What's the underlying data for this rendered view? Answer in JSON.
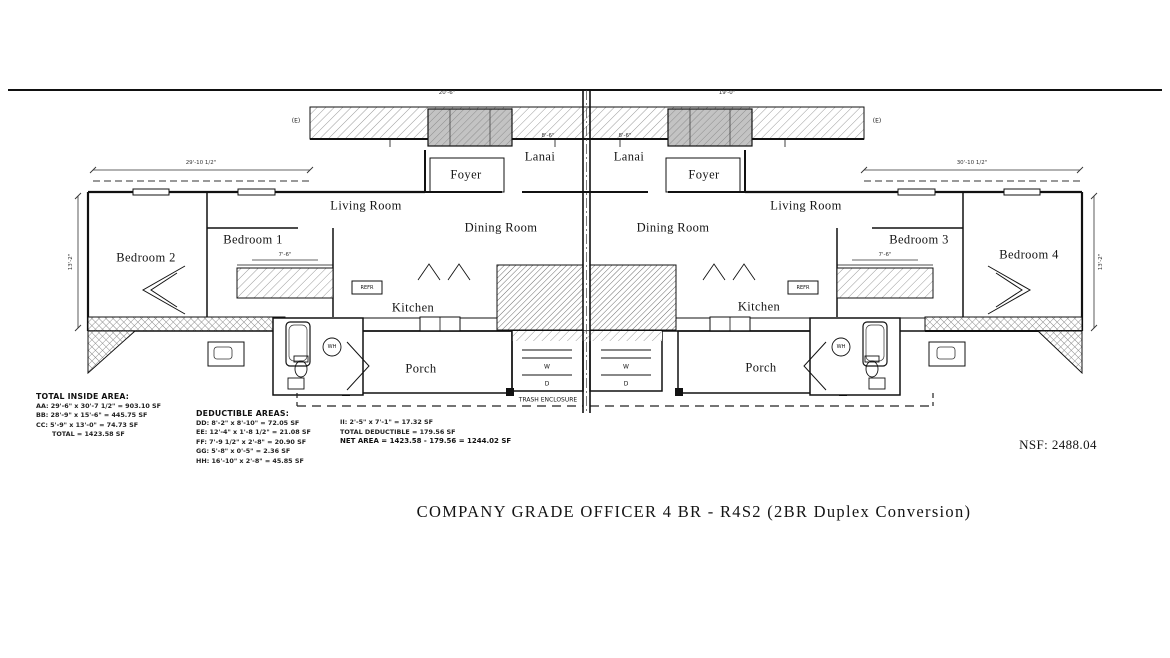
{
  "sheet": {
    "title": "COMPANY GRADE OFFICER 4 BR - R4S2 (2BR Duplex Conversion)",
    "nsf_label": "NSF: 2488.04"
  },
  "rooms": {
    "lanai_left": "Lanai",
    "lanai_right": "Lanai",
    "foyer_left": "Foyer",
    "foyer_right": "Foyer",
    "living_left": "Living Room",
    "living_right": "Living Room",
    "dining_left": "Dining Room",
    "dining_right": "Dining Room",
    "bedroom1": "Bedroom 1",
    "bedroom2": "Bedroom 2",
    "bedroom3": "Bedroom 3",
    "bedroom4": "Bedroom 4",
    "kitchen_left": "Kitchen",
    "kitchen_right": "Kitchen",
    "porch_left": "Porch",
    "porch_right": "Porch"
  },
  "fixtures": {
    "refr_left": "REFR",
    "refr_right": "REFR",
    "wh_left": "WH",
    "wh_right": "WH",
    "washer_left": "W",
    "dryer_left": "D",
    "washer_right": "W",
    "dryer_right": "D",
    "trash_enclosure": "TRASH ENCLOSURE",
    "existing_left": "(E)",
    "existing_right": "(E)"
  },
  "dimensions": {
    "top_left": "20'-6\"",
    "top_right": "19'-0\"",
    "wing_left": "29'-10 1/2\"",
    "wing_right": "30'-10 1/2\"",
    "lanai_left": "8'-6\"",
    "lanai_right": "8'-6\"",
    "closet_left": "7'-6\"",
    "closet_right": "7'-6\"",
    "side_left": "13'-2\"",
    "side_right": "13'-2\""
  },
  "area_tables": {
    "total_inside": {
      "heading": "TOTAL INSIDE AREA:",
      "rows": [
        "AA: 29'-6\" x 30'-7 1/2\" = 903.10 SF",
        "BB: 28'-9\" x 15'-6\" = 445.75 SF",
        "CC: 5'-9\" x 13'-0\" = 74.73 SF"
      ],
      "total": "TOTAL = 1423.58 SF"
    },
    "deductible": {
      "heading": "DEDUCTIBLE AREAS:",
      "rows": [
        "DD: 8'-2\" x 8'-10\" = 72.05 SF",
        "EE: 12'-4\" x 1'-8 1/2\" = 21.08 SF",
        "FF: 7'-9 1/2\" x 2'-8\" = 20.90 SF",
        "GG: 5'-8\" x 0'-5\" = 2.36 SF",
        "HH: 16'-10\" x 2'-8\" = 45.85 SF"
      ]
    },
    "summary": {
      "row_ii": "II: 2'-5\" x 7'-1\" = 17.32 SF",
      "total_deductible": "TOTAL DEDUCTIBLE = 179.56 SF",
      "net_area": "NET AREA = 1423.58 - 179.56 = 1244.02 SF"
    }
  }
}
